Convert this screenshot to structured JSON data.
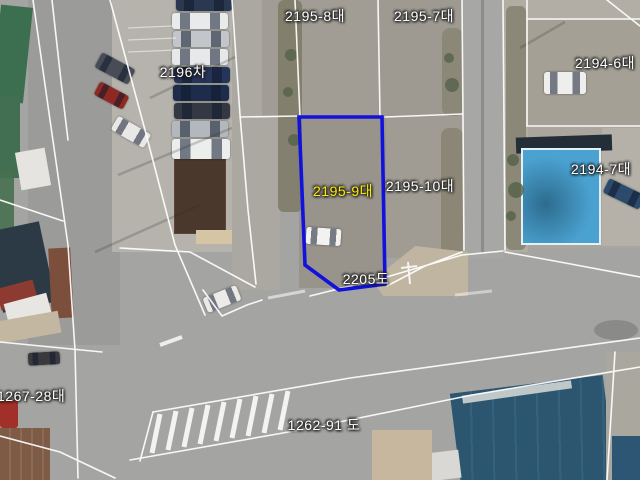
{
  "map_type": "cadastral-aerial-view",
  "overlay": {
    "parcel_line_color": "#ffffff"
  },
  "highlighted_parcel": {
    "number": "2195-9대",
    "label_color": "#ffec00",
    "outline_color": "#1212dd"
  },
  "labels": [
    {
      "id": "2195-8",
      "text": "2195-8대",
      "color": "#ffffff"
    },
    {
      "id": "2195-7",
      "text": "2195-7대",
      "color": "#ffffff"
    },
    {
      "id": "2196",
      "text": "2196차",
      "color": "#ffffff"
    },
    {
      "id": "2194-6",
      "text": "2194-6대",
      "color": "#ffffff"
    },
    {
      "id": "2194-7",
      "text": "2194-7대",
      "color": "#ffffff"
    },
    {
      "id": "2195-9",
      "text": "2195-9대",
      "color": "#ffec00"
    },
    {
      "id": "2195-10",
      "text": "2195-10대",
      "color": "#ffffff"
    },
    {
      "id": "2205",
      "text": "2205도",
      "color": "#ffffff"
    },
    {
      "id": "1267-28",
      "text": "1267-28대",
      "color": "#ffffff"
    },
    {
      "id": "1262-91",
      "text": "1262-91 도",
      "color": "#ffffff"
    }
  ]
}
